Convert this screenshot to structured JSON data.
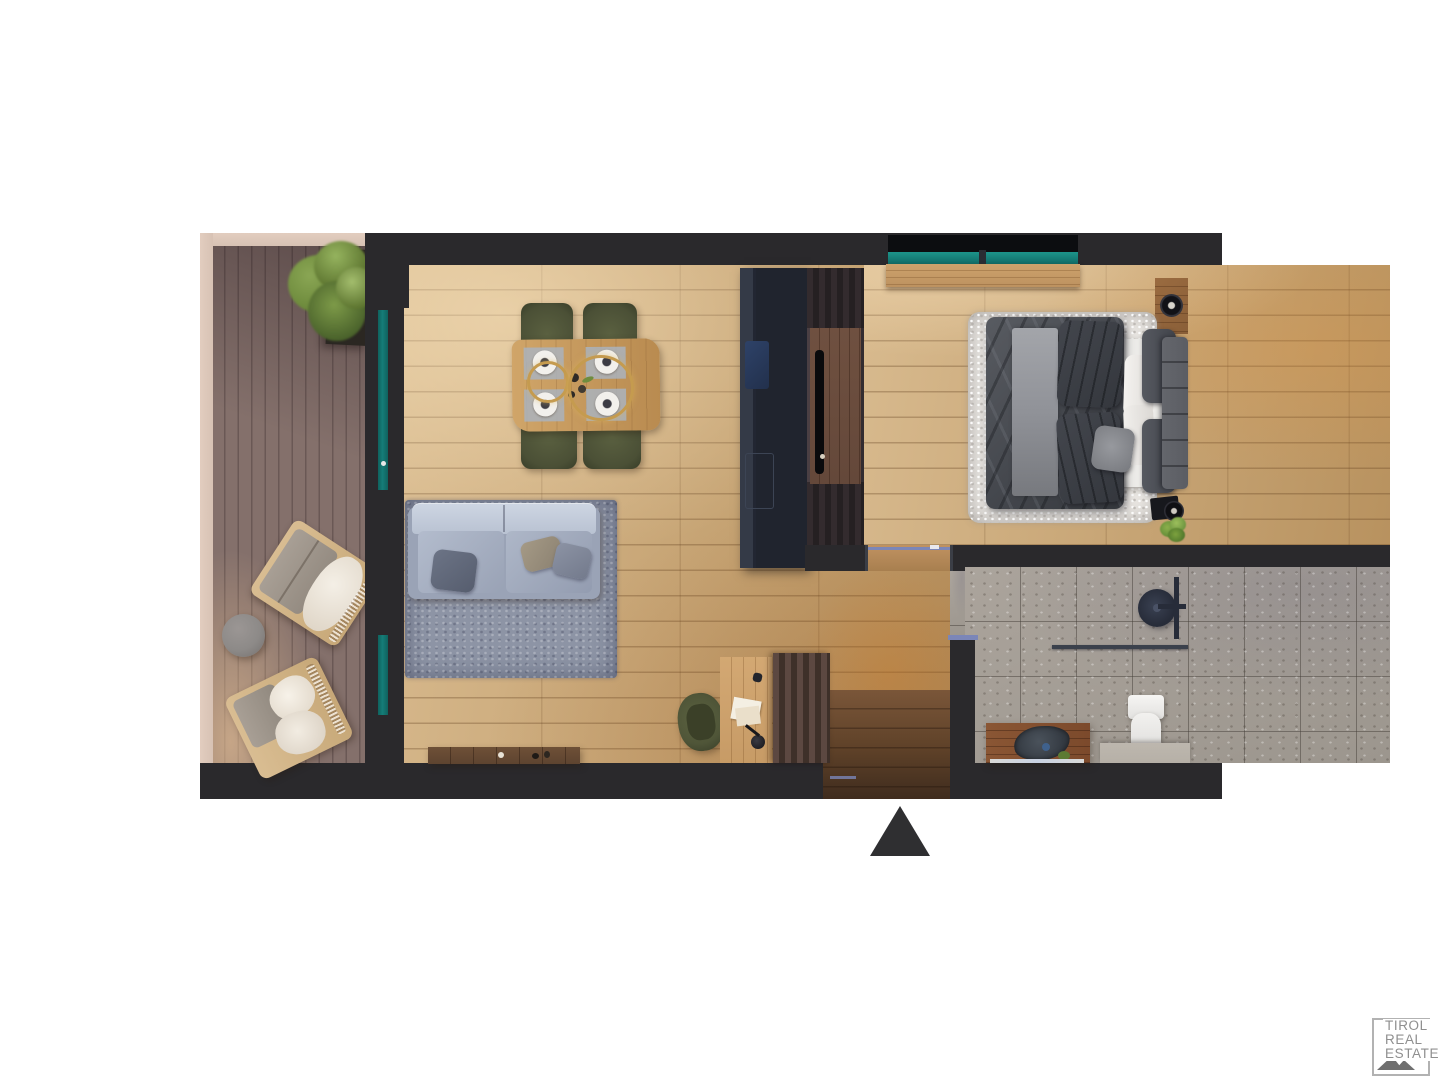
{
  "page": {
    "background": "#ffffff"
  },
  "brand": {
    "name": "TIROL REAL ESTATE",
    "lines": [
      "TIROL",
      "REAL",
      "ESTATE"
    ],
    "text_color": "#8f8f8f",
    "frame_color": "#b2b2b2",
    "mountain_color": "#6f6f6f"
  },
  "entrance_marker": {
    "icon": "triangle-up",
    "color": "#2f2f31"
  },
  "palette": {
    "wall": "#2a292c",
    "living_floor_light": "#d8ba8e",
    "living_floor_dark": "#b8925f",
    "balcony_deck": "#84706b",
    "balcony_deck_dark": "#6a5855",
    "railing": "#d7c2b4",
    "glass_teal": "#157d78",
    "kitchen_unit": "#20242e",
    "wardrobe": "#3d3437",
    "wardrobe_panel": "#64483a",
    "rug_living": "#8d94a5",
    "sofa": "#9aa3b6",
    "sofa_back": "#b9c2d2",
    "dining_chair": "#4b5036",
    "table_wood": "#c49a5f",
    "pendant_gold": "#c59b4f",
    "bed_duvet": "#45484e",
    "bed_runner": "#909298",
    "bed_pillow_dark": "#34373d",
    "bed_white": "#ecebe8",
    "headboard": "#5b5d63",
    "rug_white": "#e9e6e2",
    "bath_floor": "#a6a098",
    "fixture_dark": "#272c39",
    "toilet": "#efeeec",
    "vanity_wood": "#7c4a2c",
    "stone_bench": "#b6b0a7",
    "entry_wood": "#5e4128",
    "desk_wood": "#c79b66",
    "cabinet_wood": "#4e3c38",
    "bench_wood": "#5e4430",
    "chair_olive": "#4f5538",
    "door_frame": "#7b86b8",
    "tree_green": "#6d8a3c",
    "planter": "#2b2722",
    "side_table": "#8d8a88",
    "sill_wood": "#bd9260",
    "night_wood": "#8a5f38",
    "brand_text": "#8f8f8f"
  }
}
